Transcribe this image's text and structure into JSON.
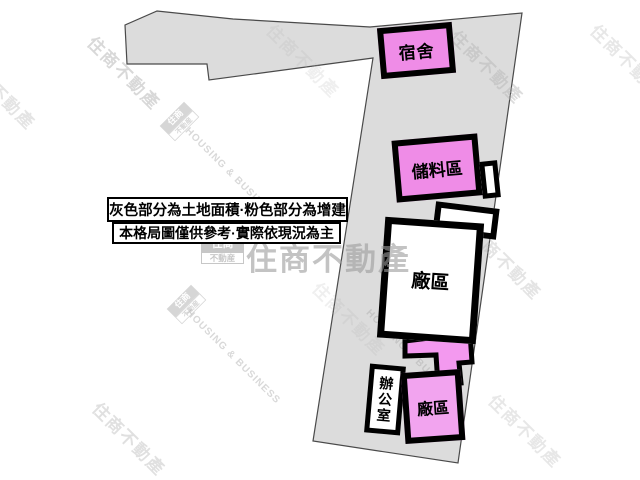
{
  "title": "土地格局示意圖",
  "colors": {
    "land_fill": "#dcdcdc",
    "land_stroke": "#4a4a4a",
    "ink": "#000000",
    "pink_a": "#ef8ce7",
    "pink_b": "#f2a4ef",
    "pink_connector": "#f399ef",
    "wm_gray": "#b3b3b3"
  },
  "legend": {
    "line1": "灰色部分為土地面積·粉色部分為增建",
    "line2": "本格局圖僅供參考·實際依現況為主"
  },
  "buildings": {
    "dorm": {
      "label": "宿舍"
    },
    "storage": {
      "label": "儲料區"
    },
    "factory_main": {
      "label": "廠區"
    },
    "office": {
      "label": "辦公室"
    },
    "factory_pink": {
      "label": "廠區"
    }
  },
  "watermarks": {
    "brand_text": "住商不動產",
    "brand_en": "HOUSING & BUSINESS",
    "logo_top": "住商",
    "logo_bottom": "不動産"
  }
}
